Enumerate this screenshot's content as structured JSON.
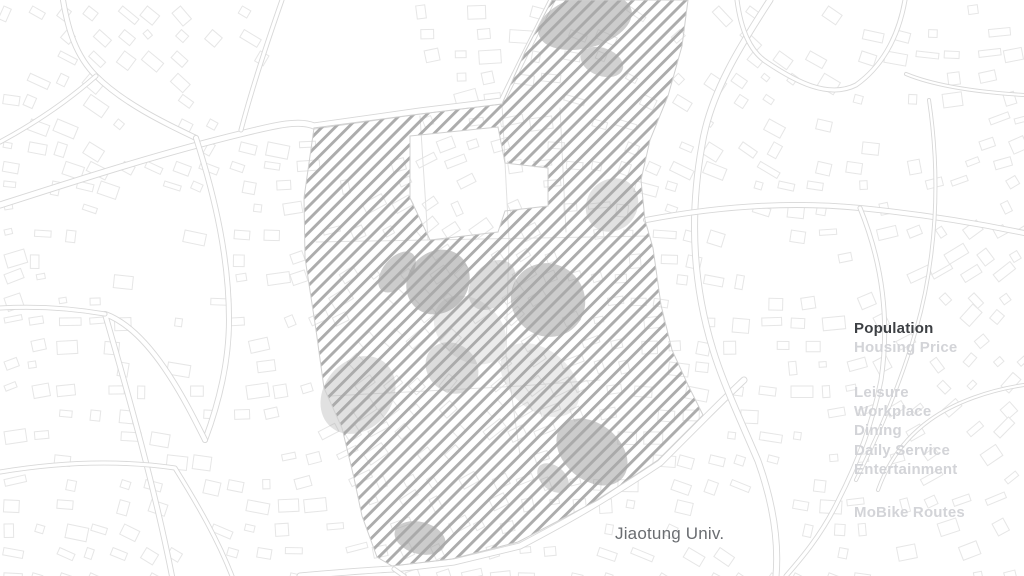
{
  "map": {
    "place_label": "Jiaotung Univ."
  },
  "menu": {
    "items": [
      {
        "label": "Population",
        "selected": true
      },
      {
        "label": "Housing Price",
        "selected": false
      },
      {
        "label": "Leisure",
        "selected": false
      },
      {
        "label": "Workplace",
        "selected": false
      },
      {
        "label": "Dining",
        "selected": false
      },
      {
        "label": "Daily Service",
        "selected": false
      },
      {
        "label": "Entertainment",
        "selected": false
      },
      {
        "label": "MoBike Routes",
        "selected": false
      }
    ]
  },
  "colors": {
    "background": "#ffffff",
    "selected_text": "#3d4044",
    "inactive_text": "#d3d4d8",
    "map_label_text": "#6a6d71",
    "hatch_line": "#a8a8a8",
    "building_outline": "#e6e6e6",
    "road_edge": "#d8d8d8",
    "campus_building_fill": "#9a9a9a",
    "region_border": "#d0d0d0"
  }
}
